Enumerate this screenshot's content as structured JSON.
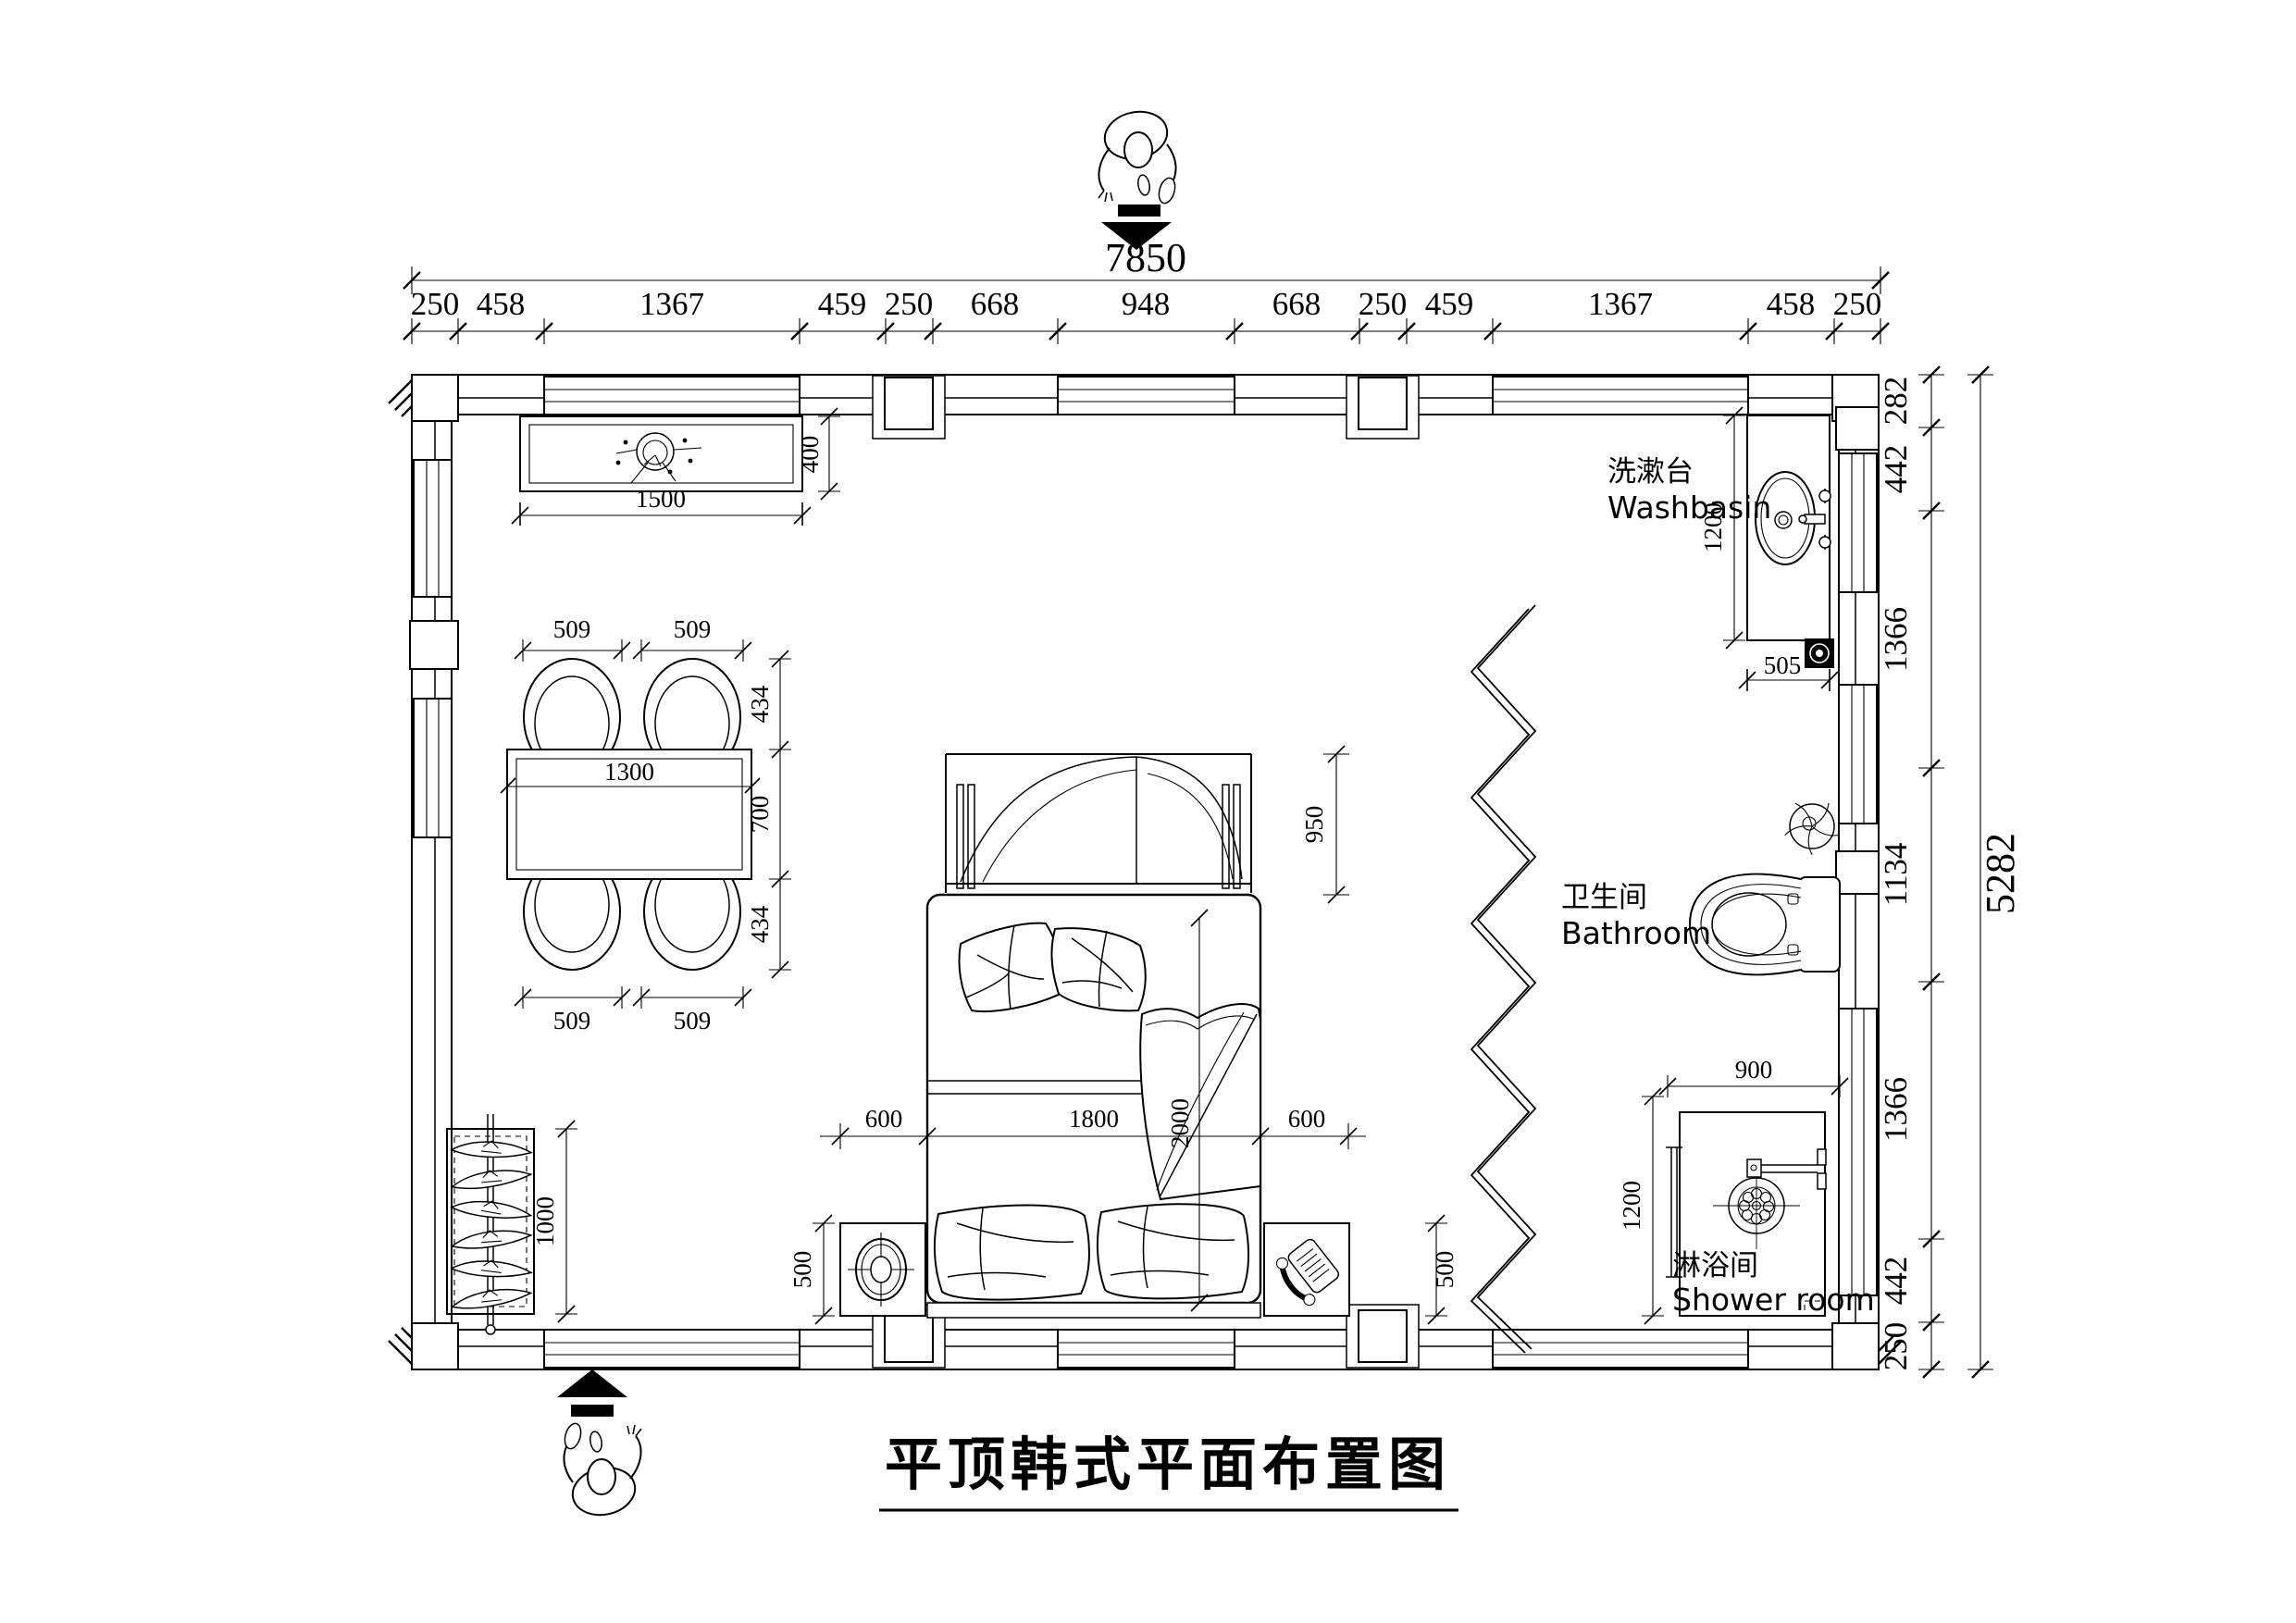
{
  "title": {
    "text": "平顶韩式平面布置图"
  },
  "overall": {
    "width": "7850",
    "height": "5282"
  },
  "top_dims": [
    "250",
    "458",
    "1367",
    "459",
    "250",
    "668",
    "948",
    "668",
    "250",
    "459",
    "1367",
    "458",
    "250"
  ],
  "right_dims": [
    "282",
    "442",
    "1366",
    "1134",
    "1366",
    "442",
    "250"
  ],
  "tv": {
    "width": "1500",
    "depth": "400"
  },
  "dining": {
    "chair_w": "509",
    "chair_d": "434",
    "table_w": "1300",
    "table_d": "700"
  },
  "bed": {
    "side": "600",
    "width": "1800",
    "length": "2000",
    "canopy": "950"
  },
  "nightstand": {
    "depth": "500"
  },
  "wardrobe": {
    "height": "1000"
  },
  "washbasin": {
    "label_zh": "洗漱台",
    "label_en": "Washbasin",
    "depth": "1200",
    "width": "505"
  },
  "bathroom": {
    "label_zh": "卫生间",
    "label_en": "Bathroom"
  },
  "shower": {
    "label_zh": "淋浴间",
    "label_en": "Shower room",
    "width": "900",
    "depth": "1200"
  }
}
